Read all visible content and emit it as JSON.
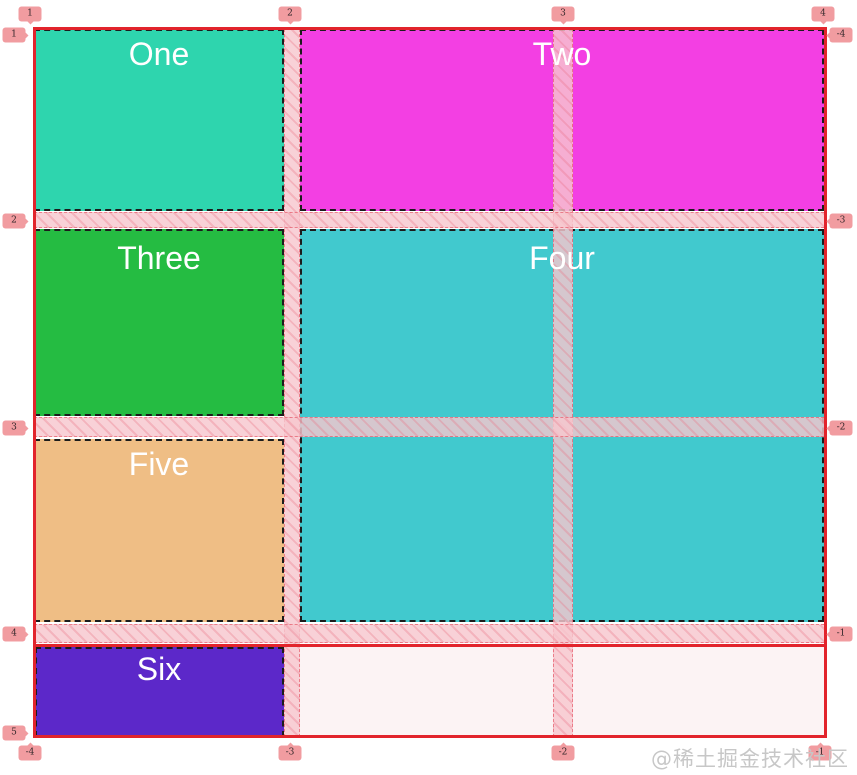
{
  "grid_lines": {
    "top": [
      "1",
      "2",
      "3",
      "4"
    ],
    "bottom": [
      "-4",
      "-3",
      "-2",
      "-1"
    ],
    "left": [
      "1",
      "2",
      "3",
      "4",
      "5"
    ],
    "right": [
      "-4",
      "-3",
      "-2",
      "-1"
    ]
  },
  "items": [
    {
      "id": "one",
      "label": "One",
      "color": "#2ed5ae"
    },
    {
      "id": "two",
      "label": "Two",
      "color": "#f33fe3"
    },
    {
      "id": "three",
      "label": "Three",
      "color": "#25bc42"
    },
    {
      "id": "four",
      "label": "Four",
      "color": "#41c9ce"
    },
    {
      "id": "five",
      "label": "Five",
      "color": "#efbe85"
    },
    {
      "id": "six",
      "label": "Six",
      "color": "#5c28c9"
    }
  ],
  "empty_track_color": "#fcf3f4",
  "overlay_colors": {
    "grid_line_red": "#e2242c",
    "gap_fill": "#f7c7ce",
    "badge_background": "#f19ca0",
    "item_border": "#1c1c1c"
  },
  "watermark": "@稀土掘金技术社区"
}
